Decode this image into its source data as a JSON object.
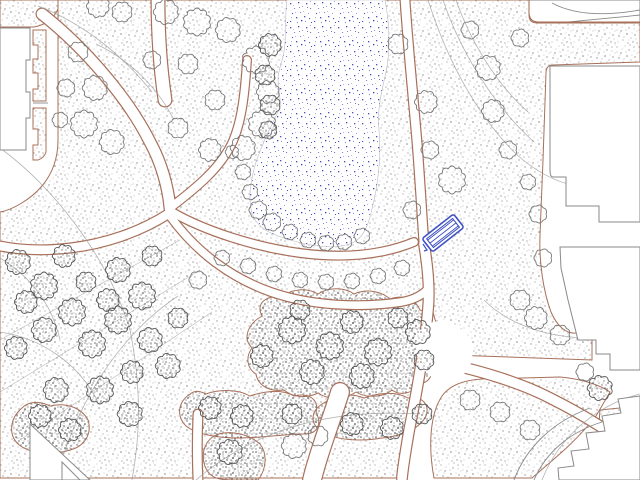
{
  "map": {
    "type": "site-plan",
    "title": "landscape-site-plan",
    "colors": {
      "background": "#ffffff",
      "grass_outline": "#a8705a",
      "building_outline": "#8a8a8a",
      "contour": "#999999",
      "tree_light": "#787878",
      "tree_dark": "#555555",
      "pond_dot": "#4444bb",
      "bench_blue": "#3f51c4"
    },
    "grass": [
      "M0,0 L58,0 L58,9 Q51,24 34,27 L0,27 Z",
      "M33,30 L46,30 L46,101 L33,101 L33,89 L38,89 L38,73 L33,73 L33,59 L38,59 L38,45 L33,45 Z",
      "M33,108 L46,108 L46,152 Q44,158 38,160 L33,160 L33,145 L38,145 L38,129 L33,129 Z",
      "M58,0 L404,0 C406,60 411,130 417,190 C420,222 424,258 428,292 C432,338 424,390 412,432 C407,450 404,464 403,478 L0,478 L0,212 C12,210 30,200 42,186 C52,174 58,158 58,140 Z",
      "M404,0 L529,0 L529,15 C529,21 532,23 538,23 L640,23 L640,62 L553,65 C548,65 546,68 546,73 L543,160 L540,235 C539,262 543,290 551,312 C557,326 566,334 576,333 L592,338 L592,360 L452,355 C441,341 433,317 428,290 C423,260 419,222 416,182 L407,60 Z",
      "M434,478 C428,446 430,414 442,396 C450,385 464,380 482,379 L560,377 C582,379 600,385 610,392 L596,416 C574,444 550,462 532,478 Z",
      "M600,410 L640,406 L640,444 L614,447 C602,440 598,426 600,410 Z"
    ],
    "shrubs": [
      "M262,316 C255,302 268,295 282,297 C292,288 308,288 318,294 C330,286 346,288 354,294 C368,288 382,292 390,299 C404,294 416,300 420,310 C430,312 434,322 430,334 C438,342 438,354 430,360 C436,372 430,382 420,384 C412,394 400,396 392,390 C382,398 366,398 356,392 C344,400 328,400 318,393 C306,399 292,397 284,390 C270,392 258,386 256,374 C246,368 246,356 252,348 C242,338 248,324 262,316 Z",
      "M190,394 C178,402 176,416 186,426 C196,434 216,438 240,438 C262,438 284,434 304,434 C318,434 322,424 316,412 C320,400 308,392 294,396 C280,388 262,392 250,396 C236,388 216,390 206,394 C198,390 194,391 190,394 Z",
      "M214,436 C202,444 200,460 208,472 C214,480 224,480 238,480 L258,480 C266,470 268,454 260,444 C246,432 226,430 214,436 Z",
      "M322,404 C310,412 310,424 322,432 C336,440 360,442 382,438 C404,436 420,428 426,416 C430,404 422,396 408,398 C394,390 376,394 364,398 C350,392 334,396 322,404 Z",
      "M22,408 C10,418 8,434 18,444 C30,454 52,456 70,450 C86,446 92,432 88,420 C82,408 66,402 50,406 C38,400 28,402 22,408 Z"
    ],
    "pond": {
      "d": "M287,0 C284,22 288,44 281,64 C274,84 282,94 280,108 C272,124 263,142 256,162 C250,182 247,204 254,218 C261,231 276,236 294,241 C312,246 336,250 352,243 C366,237 370,219 374,200 C379,178 381,152 379,130 C377,110 381,94 386,72 C391,48 389,20 385,0 Z"
    },
    "paths": [
      {
        "d": "M42,14 C85,48 128,98 150,142 C161,162 168,186 170,208",
        "w": 13
      },
      {
        "d": "M158,0 C158,35 160,66 165,100",
        "w": 15
      },
      {
        "d": "M170,208 C196,188 221,168 233,141 C242,120 245,92 247,60",
        "w": 10
      },
      {
        "d": "M172,212 C205,231 255,247 300,253 C345,259 382,255 414,242",
        "w": 10
      },
      {
        "d": "M405,0 C408,46 413,95 417,142 C420,180 422,216 424,244",
        "w": 11
      },
      {
        "d": "M424,244 C428,268 430,289 428,309 C425,346 417,391 409,431 C405,455 403,466 402,478",
        "w": 12
      },
      {
        "d": "M170,216 C196,252 231,278 271,292 C311,306 361,308 401,302 C413,300 421,296 427,290",
        "w": 10
      },
      {
        "d": "M168,214 C140,232 105,244 70,248 C45,251 20,250 0,246",
        "w": 11
      },
      {
        "d": "M430,360 C470,368 515,380 550,398 C580,413 612,432 638,454",
        "w": 12
      },
      {
        "d": "M340,392 C330,424 318,454 312,480",
        "w": 20
      },
      {
        "d": "M198,414 C197,440 197,460 198,480",
        "w": 11
      }
    ],
    "plaza": [
      "M420,330 C432,318 450,318 462,330 C474,342 476,360 466,372 C454,384 436,384 426,372 C416,360 412,344 420,330 Z"
    ],
    "contours": [
      "M38,6 C80,22 120,52 152,92",
      "M96,44 C130,60 158,88 174,120",
      "M0,148 C52,186 108,256 130,330 C142,390 140,436 132,480",
      "M56,480 C76,404 118,336 178,296",
      "M428,0 C446,56 474,112 516,154 C536,172 556,182 576,186",
      "M443,0 C460,50 492,104 534,142",
      "M456,0 C470,40 496,84 528,112",
      "M196,480 C252,432 324,408 420,414",
      "M0,332 C40,338 78,362 98,402",
      "M542,480 C560,434 600,404 640,394",
      "M0,258 C30,276 52,304 60,340",
      "M484,300 C506,322 540,336 584,338"
    ],
    "cluster_hatch": [
      "M0,340 L180,240",
      "M0,392 L200,270",
      "M20,440 L212,312"
    ],
    "trees_light": [
      [
        98,
        6,
        10
      ],
      [
        122,
        12,
        9
      ],
      [
        78,
        52,
        9
      ],
      [
        66,
        88,
        8
      ],
      [
        95,
        88,
        11
      ],
      [
        84,
        124,
        12
      ],
      [
        112,
        142,
        11
      ],
      [
        60,
        120,
        7
      ],
      [
        166,
        12,
        11
      ],
      [
        197,
        22,
        12
      ],
      [
        228,
        30,
        11
      ],
      [
        256,
        60,
        12
      ],
      [
        268,
        92,
        10
      ],
      [
        262,
        124,
        12
      ],
      [
        243,
        148,
        11
      ],
      [
        215,
        100,
        9
      ],
      [
        188,
        64,
        9
      ],
      [
        152,
        60,
        8
      ],
      [
        210,
        150,
        10
      ],
      [
        178,
        128,
        9
      ],
      [
        243,
        172,
        7
      ],
      [
        250,
        192,
        7
      ],
      [
        258,
        210,
        8
      ],
      [
        272,
        222,
        8
      ],
      [
        290,
        232,
        7
      ],
      [
        308,
        240,
        7
      ],
      [
        326,
        243,
        7
      ],
      [
        344,
        242,
        7
      ],
      [
        362,
        236,
        7
      ],
      [
        232,
        152,
        6
      ],
      [
        222,
        258,
        7
      ],
      [
        248,
        266,
        7
      ],
      [
        274,
        274,
        7
      ],
      [
        300,
        280,
        7
      ],
      [
        326,
        282,
        7
      ],
      [
        352,
        281,
        7
      ],
      [
        378,
        276,
        7
      ],
      [
        402,
        268,
        7
      ],
      [
        198,
        280,
        8
      ],
      [
        398,
        44,
        9
      ],
      [
        426,
        102,
        10
      ],
      [
        452,
        180,
        12
      ],
      [
        430,
        150,
        8
      ],
      [
        412,
        210,
        8
      ],
      [
        488,
        68,
        11
      ],
      [
        493,
        111,
        10
      ],
      [
        520,
        38,
        8
      ],
      [
        470,
        30,
        8
      ],
      [
        508,
        150,
        8
      ],
      [
        528,
        182,
        7
      ],
      [
        538,
        214,
        8
      ],
      [
        543,
        258,
        8
      ],
      [
        520,
        300,
        9
      ],
      [
        536,
        318,
        10
      ],
      [
        560,
        335,
        9
      ],
      [
        585,
        372,
        8
      ],
      [
        470,
        400,
        9
      ],
      [
        500,
        412,
        9
      ],
      [
        530,
        430,
        9
      ],
      [
        294,
        446,
        11
      ],
      [
        318,
        436,
        9
      ]
    ],
    "trees_dark": [
      [
        18,
        262,
        11
      ],
      [
        44,
        286,
        12
      ],
      [
        72,
        312,
        12
      ],
      [
        44,
        330,
        11
      ],
      [
        16,
        348,
        10
      ],
      [
        92,
        344,
        12
      ],
      [
        118,
        320,
        12
      ],
      [
        142,
        296,
        12
      ],
      [
        118,
        270,
        11
      ],
      [
        64,
        256,
        10
      ],
      [
        150,
        340,
        11
      ],
      [
        168,
        366,
        11
      ],
      [
        100,
        390,
        12
      ],
      [
        130,
        414,
        11
      ],
      [
        56,
        390,
        11
      ],
      [
        26,
        302,
        10
      ],
      [
        152,
        256,
        9
      ],
      [
        86,
        282,
        9
      ],
      [
        178,
        318,
        9
      ],
      [
        40,
        416,
        10
      ],
      [
        70,
        430,
        10
      ],
      [
        108,
        300,
        10
      ],
      [
        132,
        372,
        10
      ],
      [
        292,
        330,
        12
      ],
      [
        330,
        346,
        12
      ],
      [
        378,
        352,
        12
      ],
      [
        418,
        332,
        11
      ],
      [
        262,
        356,
        10
      ],
      [
        312,
        372,
        11
      ],
      [
        362,
        376,
        11
      ],
      [
        300,
        310,
        9
      ],
      [
        352,
        322,
        10
      ],
      [
        398,
        318,
        9
      ],
      [
        424,
        360,
        9
      ],
      [
        270,
        45,
        10
      ],
      [
        265,
        75,
        9
      ],
      [
        270,
        105,
        9
      ],
      [
        268,
        130,
        8
      ],
      [
        210,
        408,
        10
      ],
      [
        242,
        416,
        10
      ],
      [
        292,
        414,
        9
      ],
      [
        230,
        452,
        11
      ],
      [
        352,
        424,
        10
      ],
      [
        392,
        428,
        10
      ],
      [
        422,
        414,
        9
      ],
      [
        600,
        388,
        11
      ]
    ],
    "buildings": [
      "M0,28 L30,28 L30,60 L26,60 L26,92 L30,92 L30,118 L26,118 L26,150 L0,150 Z",
      "M529,0 L640,0 L640,22 L538,22 Q530,22 529,14 Z",
      "M550,66 L640,66 L640,222 L599,222 L599,206 L566,206 L566,177 L553,177 Q550,177 550,170 Z",
      "M560,247 L640,247 L640,370 L610,370 L610,354 L596,354 L596,340 L578,340 L568,300 L561,268 Z",
      "M640,396 L618,399 L621,413 L602,416 L605,431 L586,433 L589,449 L571,451 L574,466 L558,468 L559,480 L640,480 Z",
      "M30,424 L30,480 L90,480 Z",
      "M62,462 L62,480 L80,480 Z"
    ],
    "building_details_gray": [
      "M33,103 L48,103",
      "M552,3 C578,17 612,15 640,10",
      "M568,22 C598,19 622,17 640,15",
      "M514,480 C526,448 552,422 590,408",
      "M534,480 C546,452 570,432 602,422"
    ],
    "building_details_sienna": [
      "M529,0 L529,14 Q530,22 538,22 L640,22"
    ],
    "bench": {
      "cx": 443,
      "cy": 233,
      "w": 40,
      "h": 17,
      "rot": -38,
      "mark": "M423,244 L427,250 L424,251"
    }
  }
}
